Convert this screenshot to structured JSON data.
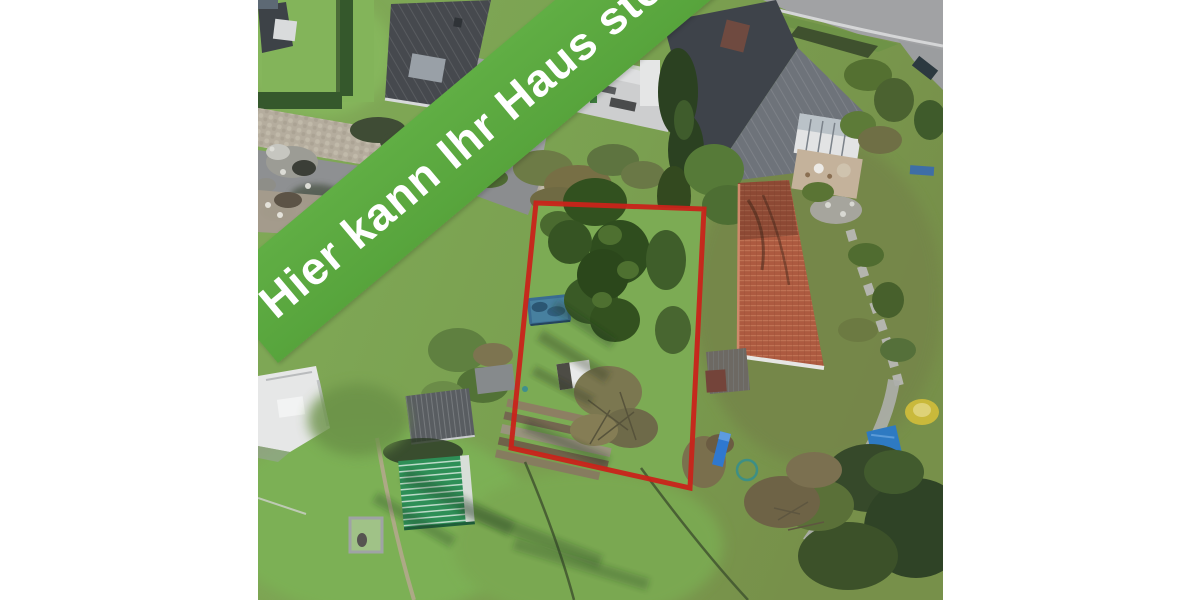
{
  "banner": {
    "text": "Hier kann Ihr Haus stehen"
  },
  "colors": {
    "page_background": "#ffffff",
    "banner_green": "#57a43c",
    "banner_green_light": "#60ae44",
    "banner_text": "#ffffff",
    "plot_outline_red": "#c9231a"
  },
  "scene": {
    "description_labels": {
      "plot_boundary": "red-outlined building plot",
      "lawn": "#7cab54",
      "dark_roof": "#3f444a",
      "orange_tile_roof": "#ad5a40",
      "green_garden_shed": "#2e8f57",
      "pool_cover_blue": "#3a6c92",
      "tarp_blue": "#2e7ac2",
      "stone_path": "#b2b3ad",
      "yellow_bush": "#c9b93b",
      "road_gray": "#a1a2a4",
      "cobblestone_street": "#b5ad9e"
    }
  }
}
